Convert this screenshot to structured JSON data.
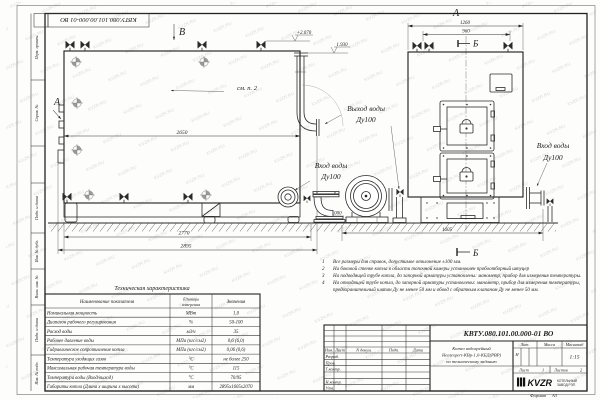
{
  "watermark": "KVZR.RU",
  "corner_stamp": "КВТУ.080.101.00.000-01  ВО",
  "side_strip": {
    "perv_primen": "Перв. примен.",
    "sprav_no": "Справ. №",
    "podp_data_1": "Подп. и дата",
    "inv_dubl": "Инв. № дубл.",
    "vzam_inv": "Взам. инв. №",
    "podp_data_2": "Подп. и дата",
    "inv_podl": "Инв. № подл."
  },
  "views": {
    "label_b": "В",
    "label_a_top": "А",
    "label_a_side": "А",
    "see_note": "см. п. 2",
    "section_b_top": "Б",
    "section_b_bottom": "Б",
    "outlet_line1": "Выход воды",
    "outlet_line2": "Ду100",
    "inlet_line1": "Вход воды",
    "inlet_line2": "Ду100",
    "inlet_right_line1": "Вход воды",
    "inlet_right_line2": "Ду100",
    "dim_2650": "2650",
    "dim_2770": "2770",
    "dim_2895": "2895",
    "dim_1260": "1260",
    "dim_960": "960",
    "dim_1605": "1605",
    "level_top": "+2.070",
    "level_outlet": "1.930",
    "level_zero": "0.000"
  },
  "notes": {
    "items": [
      {
        "num": "1",
        "text": "Все размеры для справок, допустимое отклонение ±100 мм."
      },
      {
        "num": "2",
        "text": "На боковой стенке котла в области топочной камеры установлен пробоотборный штуцер"
      },
      {
        "num": "3",
        "text": "На подводящей трубе котла, до запорной арматуры установлены: манометр, прибор для измерения температуры."
      },
      {
        "num": "4",
        "text": "На отводящей трубе котла, до запорной арматуры установлены: манометр, прибор для измерения температуры, предохранительный клапан Ду не менее 50 мм и обвод с обратным клапаном Ду не менее 50 мм."
      }
    ]
  },
  "tech_table": {
    "title": "Техническая характеристика",
    "col_name": "Наименование показателя",
    "col_units_1": "Единицы",
    "col_units_2": "измерения",
    "col_value": "Значения",
    "rows": [
      {
        "name": "Номинальная мощность",
        "units": "МВт",
        "value": "1,0"
      },
      {
        "name": "Диапазон рабочего регулирования",
        "units": "%",
        "value": "50-100"
      },
      {
        "name": "Расход воды",
        "units": "м3/ч",
        "value": "35"
      },
      {
        "name": "Рабочее давление воды",
        "units": "МПа (кгс/см2)",
        "value": "0,6 (6,0)"
      },
      {
        "name": "Гидравлическое сопротивление котла",
        "units": "МПа (кгс/см2)",
        "value": "0,06 (0,6)"
      },
      {
        "name": "Температура уходящих газов",
        "units": "°С",
        "value": "не более 250"
      },
      {
        "name": "Максимальная рабочая температура воды",
        "units": "°С",
        "value": "115"
      },
      {
        "name": "Температура воды (Вход/выход)",
        "units": "°С",
        "value": "70/95"
      },
      {
        "name": "Габариты котла (Длина х ширина х высота)",
        "units": "мм",
        "value": "2895х1605х2070"
      }
    ]
  },
  "title_block": {
    "designation": "КВТУ.080.101.00.000-01  ВО",
    "rev_headers": {
      "izm": "Изм.",
      "list": "Лист",
      "doc": "N докум.",
      "podp": "Подп.",
      "data": "Дата"
    },
    "roles": [
      "Разраб.",
      "Пров.",
      "Т.контр.",
      "",
      "Н.контр.",
      "Утв."
    ],
    "name_line1": "Котел водогрейный",
    "name_line2": "Heatexpert-КВр-1,0-КБД(РВР)",
    "name_line3": "по техническому заданию",
    "lit_header": "Лит.",
    "mass_header": "Масса",
    "scale_header": "Масштаб",
    "lit_value": "И",
    "scale_value": "1:15",
    "sheet_label": "Лист",
    "sheet_value": "1",
    "sheets_label": "Листов",
    "sheets_value": "2",
    "logo_text": "KVZR",
    "logo_sub1": "КОТЕЛЬНЫЙ",
    "logo_sub2": "ЗАВОД РЭП",
    "format_label": "Формат",
    "format_value": "А3"
  }
}
